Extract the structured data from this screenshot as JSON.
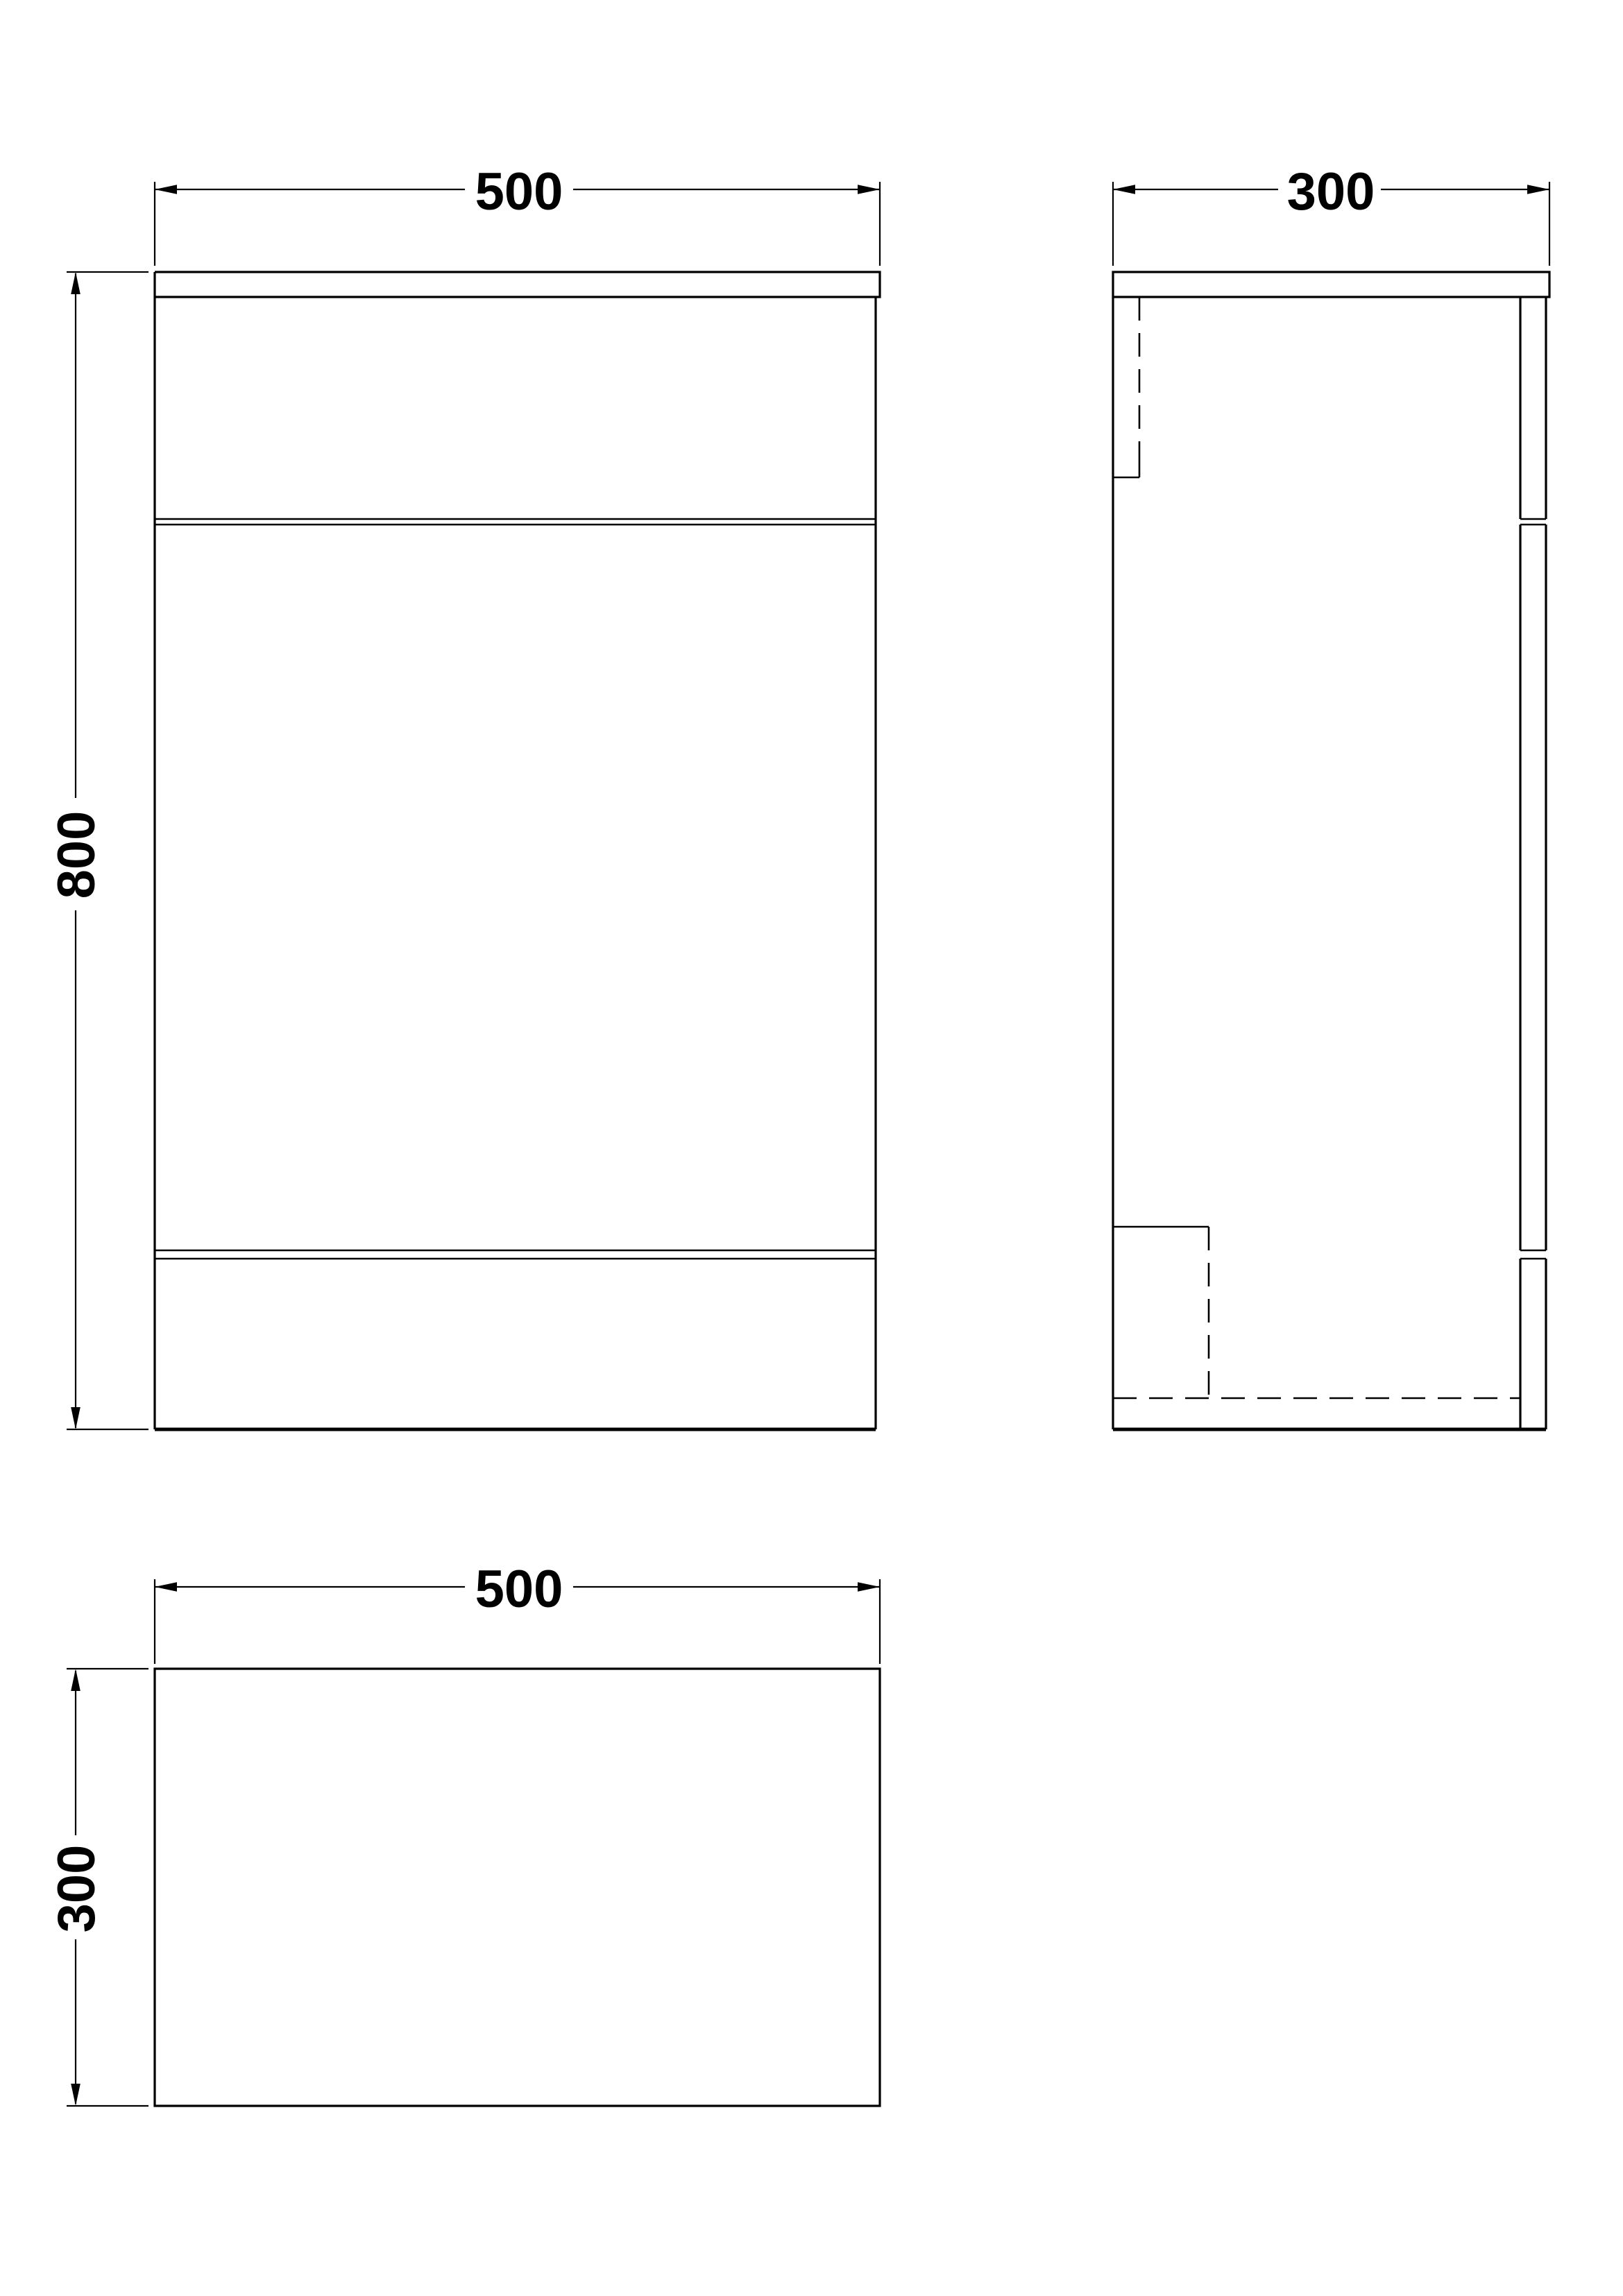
{
  "page": {
    "background_color": "#ffffff",
    "line_color": "#000000",
    "drawing_type": "technical-dimension-drawing"
  },
  "views": {
    "front_elevation": {
      "width_label": "500",
      "height_label": "800"
    },
    "side_elevation": {
      "depth_label": "300"
    },
    "plan_view": {
      "width_label": "500",
      "depth_label": "300"
    }
  }
}
